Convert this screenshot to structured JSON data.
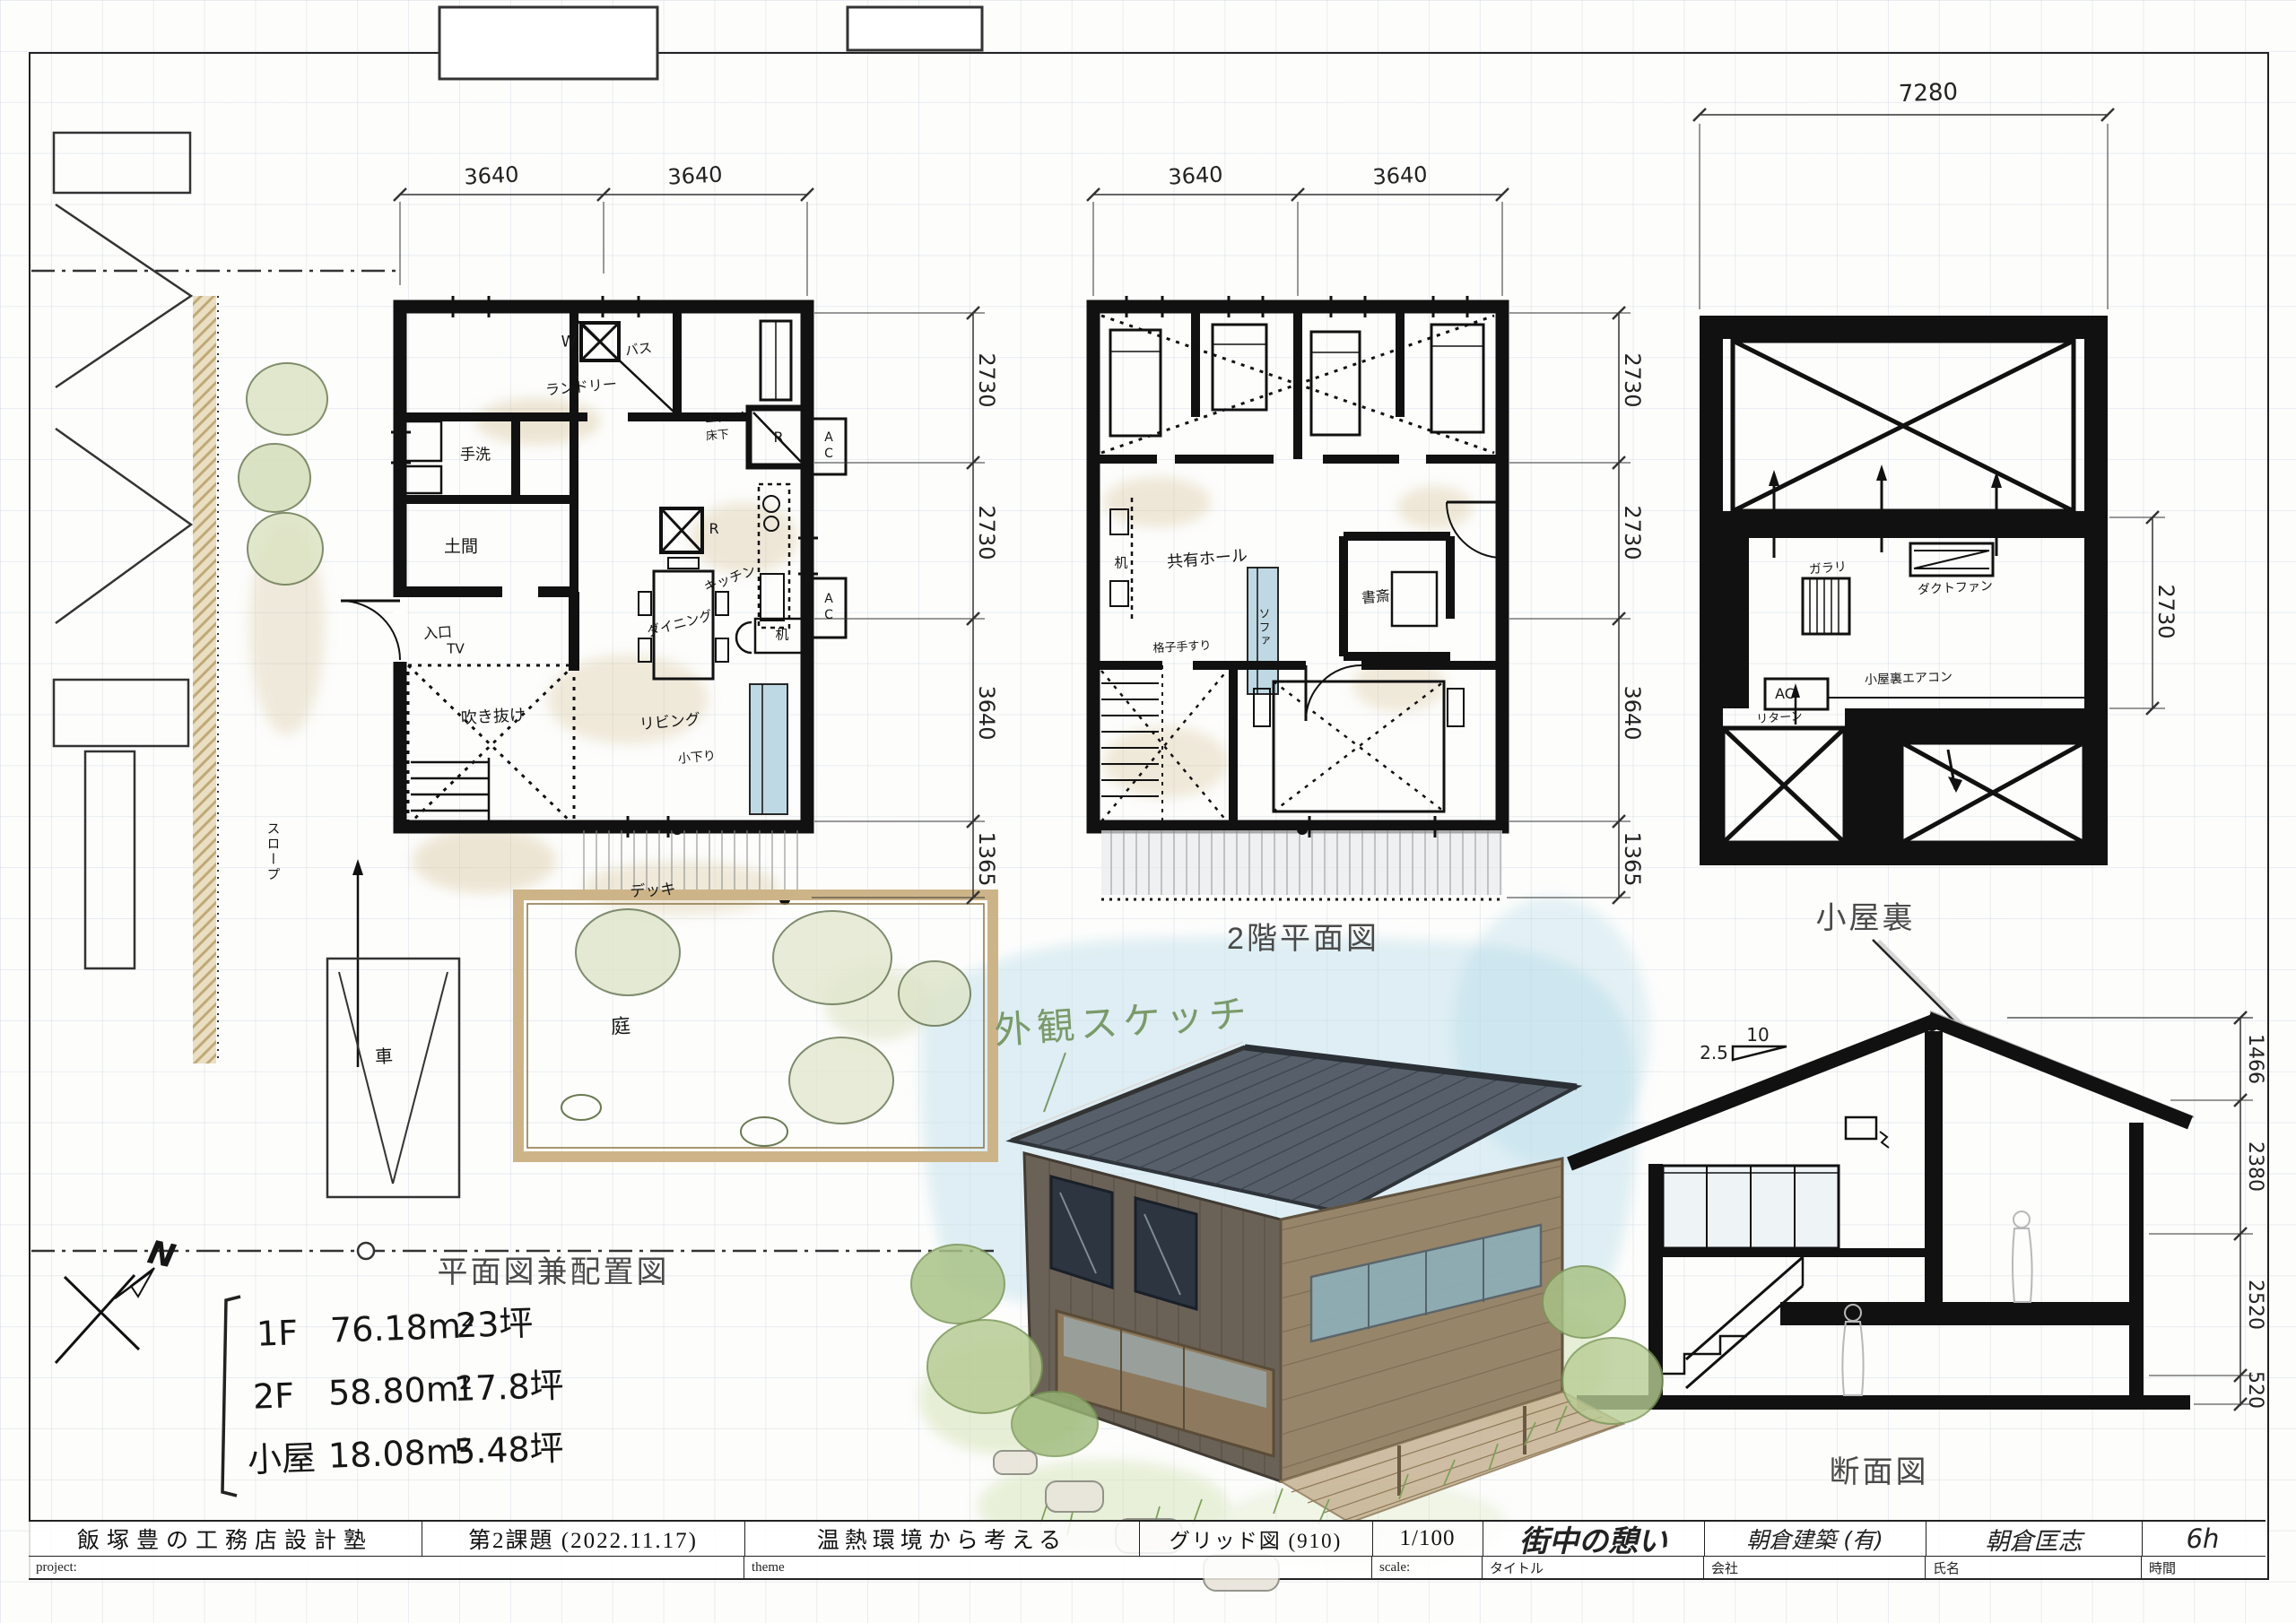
{
  "figure_titles": {
    "plan1": "平面図兼配置図",
    "plan2": "2階平面図",
    "attic": "小屋裏",
    "section": "断面図",
    "sketch": "外観スケッチ"
  },
  "north": {
    "label": "N"
  },
  "area_summary": {
    "rows": [
      {
        "floor": "1F",
        "area": "76.18m²",
        "tsubo": "23坪"
      },
      {
        "floor": "2F",
        "area": "58.80m²",
        "tsubo": "17.8坪"
      },
      {
        "floor": "小屋",
        "area": "18.08m²",
        "tsubo": "5.48坪"
      }
    ]
  },
  "plan1": {
    "dims_top": [
      "3640",
      "3640"
    ],
    "dims_right": [
      "2730",
      "2730",
      "3640",
      "1365"
    ],
    "labels": {
      "laundry": "ランドリー",
      "washer": "W",
      "bath": "バス",
      "handwash": "手洗",
      "doma": "土間",
      "entrance": "入口",
      "aircon": "エアコン",
      "underfloor": "床下",
      "closet_r": "R",
      "fridge_r": "R",
      "ac1": "AC",
      "ac2": "AC",
      "kitchen": "キッチン",
      "dining": "ダイニング",
      "desk": "机",
      "tv": "TV",
      "void": "吹き抜け",
      "living": "リビング",
      "step": "小下り",
      "deck": "デッキ",
      "slope": "スロープ",
      "garden": "庭",
      "car": "車"
    }
  },
  "plan2": {
    "dims_top": [
      "3640",
      "3640"
    ],
    "dims_right": [
      "2730",
      "2730",
      "3640",
      "1365"
    ],
    "labels": {
      "desk": "机",
      "hall": "共有ホール",
      "sofa": "ソファ",
      "study": "書斎",
      "handrail": "格子手すり"
    }
  },
  "attic": {
    "dim_top": "7280",
    "dim_right": "2730",
    "labels": {
      "louver": "ガラリ",
      "duct_fan": "ダクトファン",
      "ac": "AC",
      "attic_aircon": "小屋裏エアコン",
      "return": "リターン"
    }
  },
  "section": {
    "slope_run": "10",
    "slope_rise": "2.5",
    "dims_right": [
      "1466",
      "2380",
      "2520",
      "520"
    ]
  },
  "title_block": {
    "school": "飯塚豊の工務店設計塾",
    "assignment": "第2課題 (2022.11.17)",
    "theme_value": "温熱環境から考える",
    "grid": "グリッド図 (910)",
    "scale_value": "1/100",
    "title_value": "街中の憩い",
    "company_value": "朝倉建築 (有)",
    "name_value": "朝倉匡志",
    "time_value": "6h",
    "project_label": "project:",
    "theme_label": "theme",
    "scale_label": "scale:",
    "title_label": "タイトル",
    "company_label": "会社",
    "name_label": "氏名",
    "time_label": "時間"
  }
}
